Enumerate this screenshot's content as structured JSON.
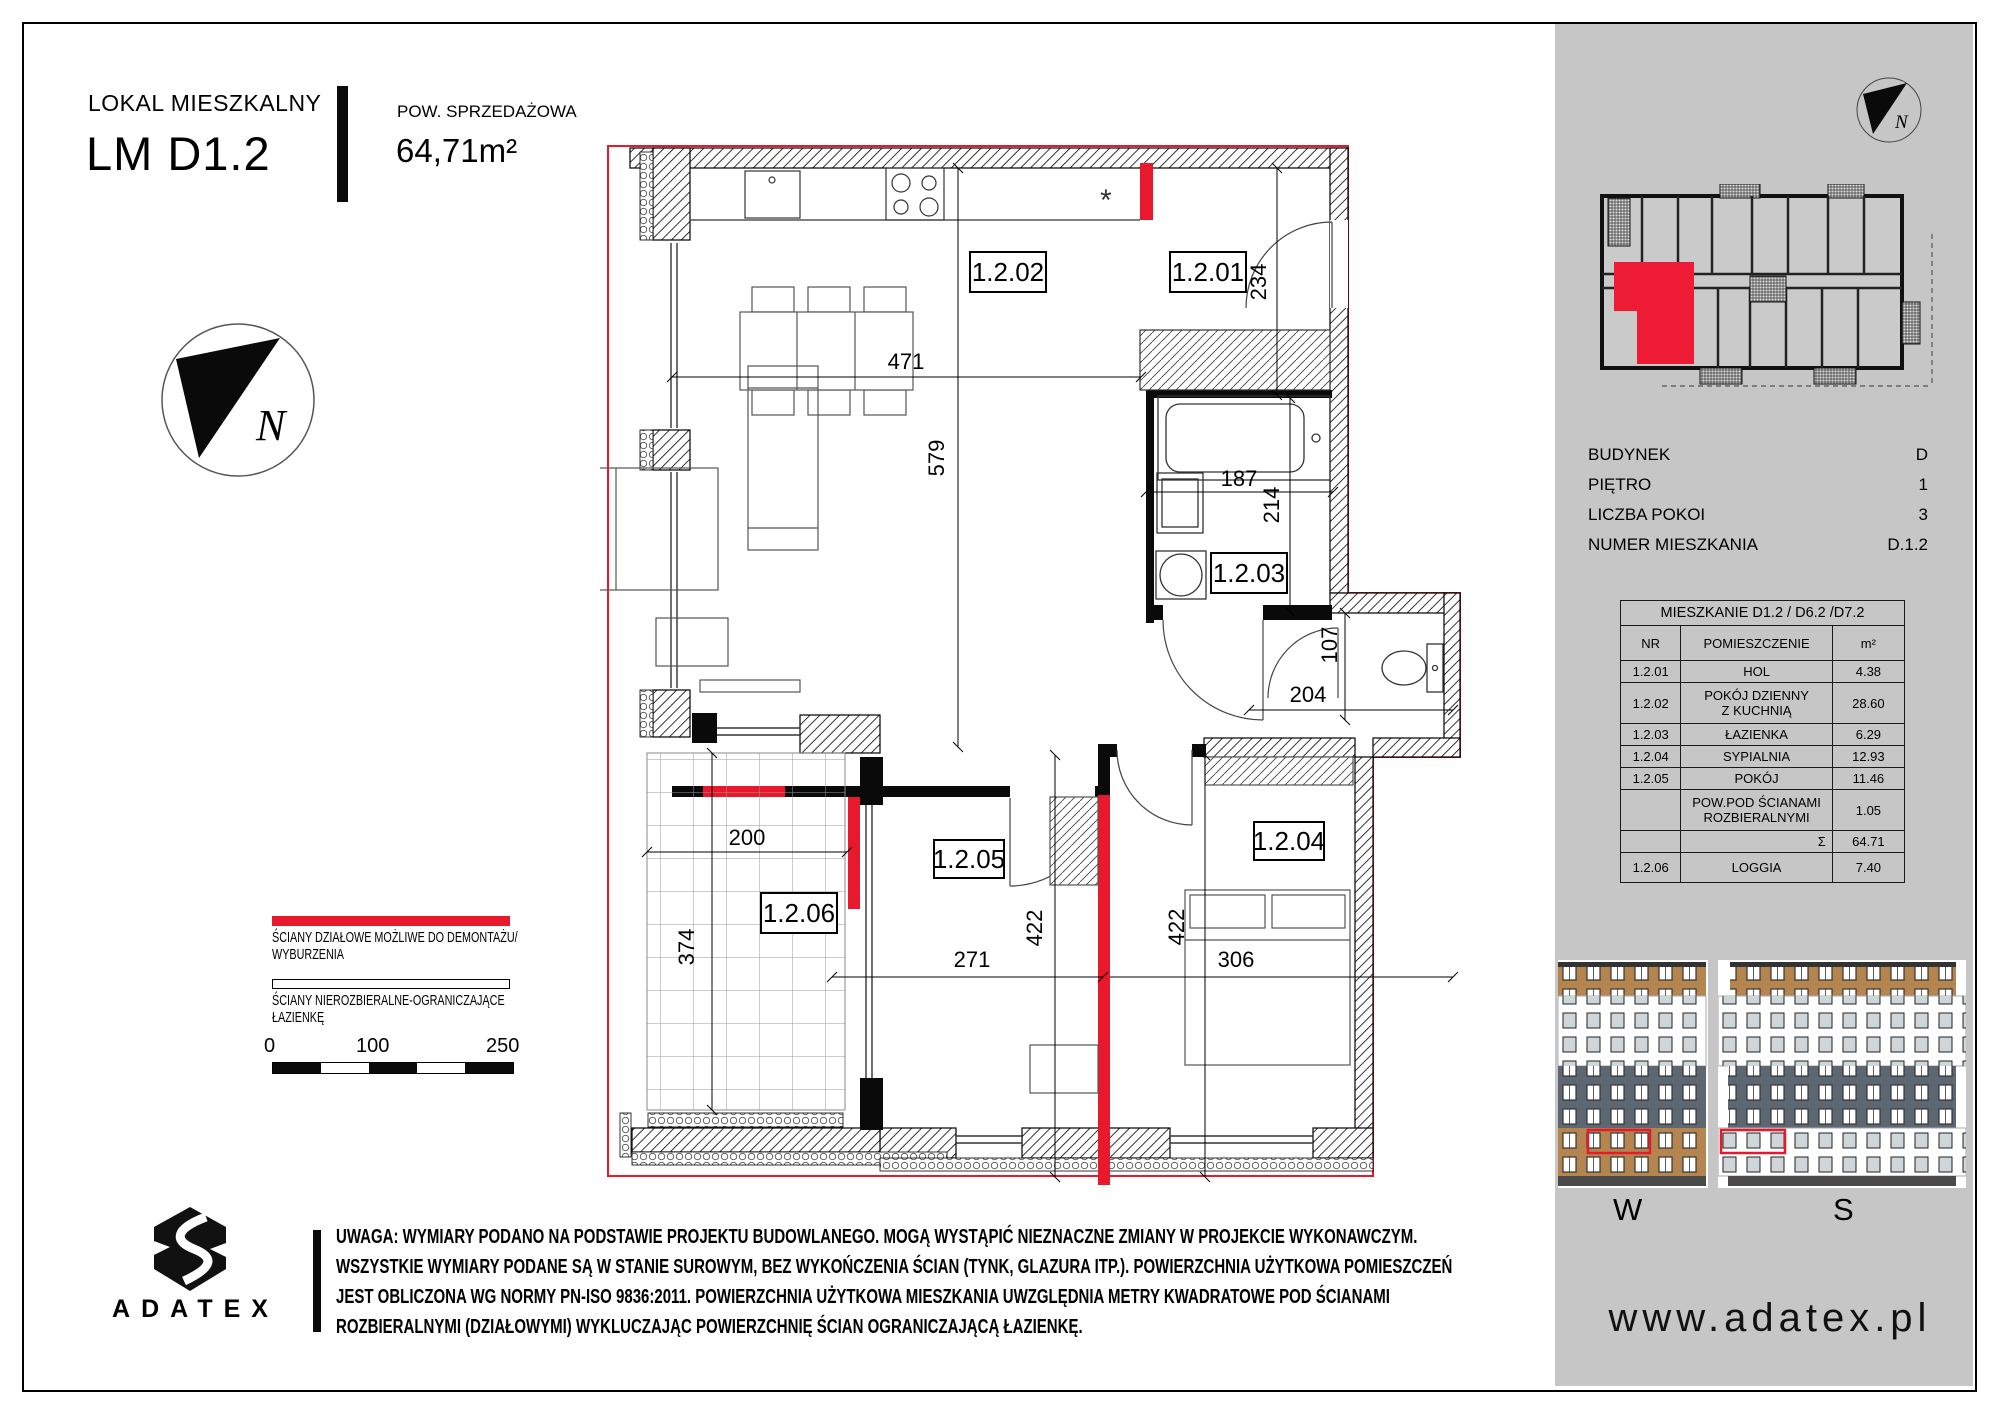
{
  "header": {
    "type_label": "LOKAL MIESZKALNY",
    "unit_code": "LM D1.2",
    "area_label": "POW. SPRZEDAŻOWA",
    "area_value": "64,71m²"
  },
  "compass": {
    "letter": "N"
  },
  "plan": {
    "room_labels": {
      "r01": "1.2.01",
      "r02": "1.2.02",
      "r03": "1.2.03",
      "r04": "1.2.04",
      "r05": "1.2.05",
      "r06": "1.2.06"
    },
    "dims": {
      "d471": "471",
      "d579": "579",
      "d234": "234",
      "d187": "187",
      "d214": "214",
      "d107": "107",
      "d204": "204",
      "d200": "200",
      "d374": "374",
      "d271": "271",
      "d422a": "422",
      "d422b": "422",
      "d306": "306"
    },
    "fridge_symbol": "*"
  },
  "legend": {
    "item1_line1": "ŚCIANY DZIAŁOWE MOŻLIWE DO DEMONTAŻU/",
    "item1_line2": "WYBURZENIA",
    "item2_line1": "ŚCIANY NIEROZBIERALNE-OGRANICZAJĄCE",
    "item2_line2": "ŁAZIENKĘ",
    "scale": {
      "start": "0",
      "mid": "100",
      "end": "250"
    }
  },
  "brand": {
    "name": "ADATEX",
    "website": "www.adatex.pl"
  },
  "disclaimer": {
    "line1": "UWAGA: WYMIARY PODANO NA PODSTAWIE PROJEKTU BUDOWLANEGO. MOGĄ WYSTĄPIĆ NIEZNACZNE ZMIANY W PROJEKCIE WYKONAWCZYM.",
    "line2": "WSZYSTKIE WYMIARY PODANE SĄ W STANIE SUROWYM, BEZ WYKOŃCZENIA ŚCIAN (TYNK, GLAZURA ITP.). POWIERZCHNIA UŻYTKOWA POMIESZCZEŃ",
    "line3": "JEST OBLICZONA WG NORMY PN-ISO 9836:2011. POWIERZCHNIA UŻYTKOWA MIESZKANIA UWZGLĘDNIA METRY KWADRATOWE POD ŚCIANAMI",
    "line4": "ROZBIERALNYMI (DZIAŁOWYMI) WYKLUCZAJĄC POWIERZCHNIĘ ŚCIAN OGRANICZAJĄCĄ ŁAZIENKĘ."
  },
  "sidebar": {
    "info": [
      {
        "label": "BUDYNEK",
        "value": "D"
      },
      {
        "label": "PIĘTRO",
        "value": "1"
      },
      {
        "label": "LICZBA POKOI",
        "value": "3"
      },
      {
        "label": "NUMER MIESZKANIA",
        "value": "D.1.2"
      }
    ],
    "table": {
      "title": "MIESZKANIE D1.2 / D6.2 /D7.2",
      "col_nr": "NR",
      "col_room": "POMIESZCZENIE",
      "col_area": "m²",
      "rows": [
        {
          "nr": "1.2.01",
          "room": "HOL",
          "area": "4.38"
        },
        {
          "nr": "1.2.02",
          "room": "POKÓJ DZIENNY\nZ KUCHNIĄ",
          "area": "28.60"
        },
        {
          "nr": "1.2.03",
          "room": "ŁAZIENKA",
          "area": "6.29"
        },
        {
          "nr": "1.2.04",
          "room": "SYPIALNIA",
          "area": "12.93"
        },
        {
          "nr": "1.2.05",
          "room": "POKÓJ",
          "area": "11.46"
        },
        {
          "nr": "",
          "room": "POW.POD ŚCIANAMI\nROZBIERALNYMI",
          "area": "1.05"
        },
        {
          "nr": "",
          "room": "Σ",
          "area": "64.71"
        },
        {
          "nr": "1.2.06",
          "room": "LOGGIA",
          "area": "7.40"
        }
      ]
    },
    "elevations": {
      "west": "W",
      "south": "S"
    }
  },
  "colors": {
    "red": "#e8192c",
    "sidebar_gray": "#c5c6c5",
    "slate": "#5c6771",
    "wood": "#b5854f"
  }
}
